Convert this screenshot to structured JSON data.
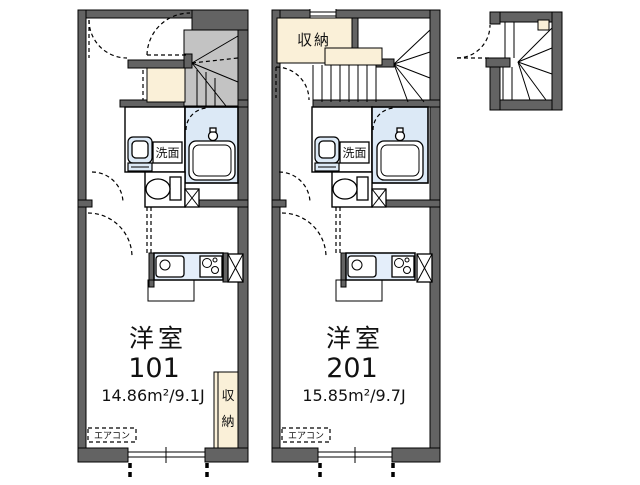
{
  "plan": {
    "unit_101": {
      "room_type_label": "洋室",
      "unit_number": "101",
      "area_text": "14.86m²/9.1J",
      "washroom_label": "洗面",
      "closet_label_top_char": "収",
      "closet_label_bottom_char": "納",
      "aircon_label": "エアコン"
    },
    "unit_201": {
      "room_type_label": "洋室",
      "unit_number": "201",
      "area_text": "15.85m²/9.7J",
      "storage_label": "収納",
      "washroom_label": "洗面",
      "aircon_label": "エアコン"
    },
    "colors": {
      "wall": "#636363",
      "stair_fill": "#c3c3c3",
      "storage_fill": "#faf0d8",
      "water_fill": "#dce9f6",
      "counter_fill": "#e4eefa"
    }
  }
}
